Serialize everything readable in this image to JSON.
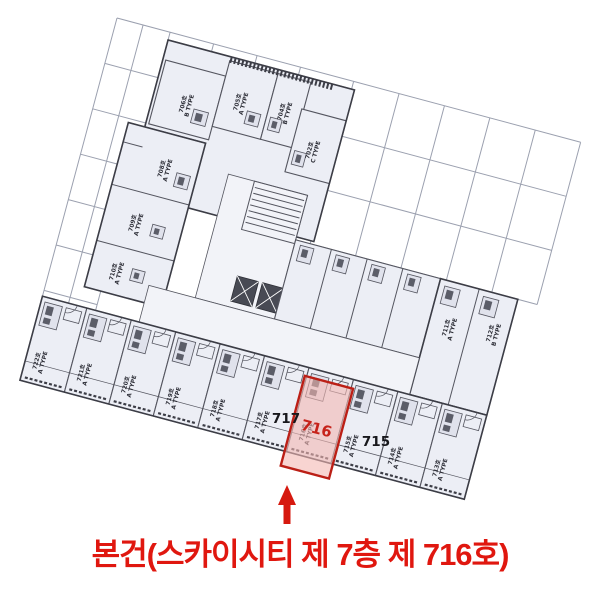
{
  "page": {
    "background": "#ffffff"
  },
  "caption": {
    "text": "본건(스카이시티 제 7층 제 716호)",
    "color": "#e0170f"
  },
  "callouts": {
    "left": "717",
    "right": "715"
  },
  "highlight": {
    "label": "716",
    "unit_label": "716호",
    "type": "A TYPE",
    "fill": "#f4b7b2",
    "border": "#bb1f16",
    "text_color": "#c6221a"
  },
  "arrow": {
    "direction": "up",
    "color": "#d6190f"
  },
  "plan": {
    "rotation_deg": 15,
    "colors": {
      "line": "#54555f",
      "wall": "#3c3d46",
      "grid": "#9ba0af",
      "room": "#eceef5",
      "corridor": "#f2f3f8",
      "fixture": "#5b5d68"
    },
    "units": [
      {
        "label": "706호",
        "type": "B TYPE",
        "x": 88,
        "y": 66
      },
      {
        "label": "705호",
        "type": "A TYPE",
        "x": 140,
        "y": 50
      },
      {
        "label": "704호",
        "type": "B TYPE",
        "x": 185,
        "y": 48
      },
      {
        "label": "702호",
        "type": "C TYPE",
        "x": 222,
        "y": 78
      },
      {
        "label": "708호",
        "type": "A TYPE",
        "x": 84,
        "y": 134
      },
      {
        "label": "709호",
        "type": "A TYPE",
        "x": 70,
        "y": 194
      },
      {
        "label": "710호",
        "type": "A TYPE",
        "x": 64,
        "y": 246
      },
      {
        "label": "711호",
        "type": "A TYPE",
        "x": 400,
        "y": 214
      },
      {
        "label": "712호",
        "type": "B TYPE",
        "x": 444,
        "y": 208
      }
    ],
    "bottom_row": [
      {
        "label": "722호",
        "type": "A TYPE"
      },
      {
        "label": "721호",
        "type": "A TYPE"
      },
      {
        "label": "720호",
        "type": "A TYPE"
      },
      {
        "label": "719호",
        "type": "A TYPE"
      },
      {
        "label": "718호",
        "type": "A TYPE"
      },
      {
        "label": "717호",
        "type": "A TYPE"
      },
      {
        "label": "716호",
        "type": "A TYPE",
        "highlight": true
      },
      {
        "label": "715호",
        "type": "A TYPE"
      },
      {
        "label": "714호",
        "type": "A TYPE"
      },
      {
        "label": "713호",
        "type": "A TYPE"
      }
    ]
  }
}
